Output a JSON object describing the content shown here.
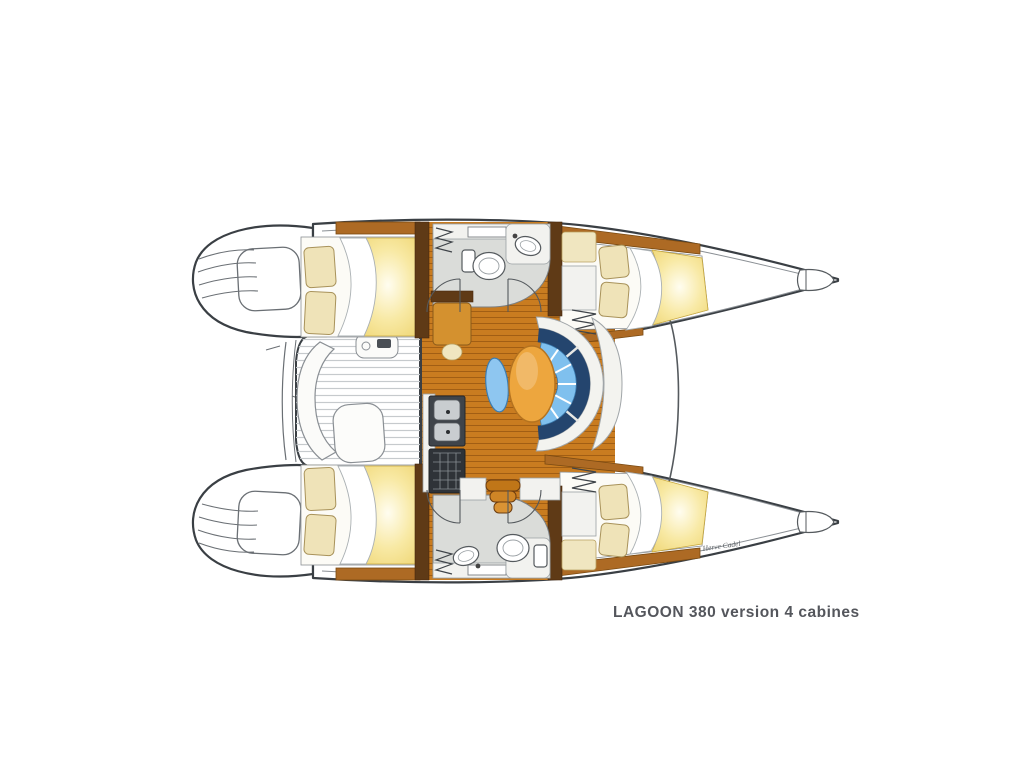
{
  "caption": {
    "text": "LAGOON 380 version 4 cabines",
    "signature": "Herve Cadel"
  },
  "palette": {
    "hull_outline": "#3a3f44",
    "wood_floor": "#c97c20",
    "wood_plank_line": "#7a3f08",
    "wood_trim": "#ad6a24",
    "dark_wood": "#5f3a16",
    "duvet_yellow": "#eccf63",
    "pillow_cream": "#efe3b8",
    "sofa_blue": "#7fc0ee",
    "sofa_navy": "#24456e",
    "table_orange": "#eda63e",
    "bathroom_gray": "#dadcd9",
    "deck_stripe_gray": "#c6cacd",
    "background": "#ffffff"
  },
  "diagram": {
    "type": "boat-floor-plan"
  }
}
